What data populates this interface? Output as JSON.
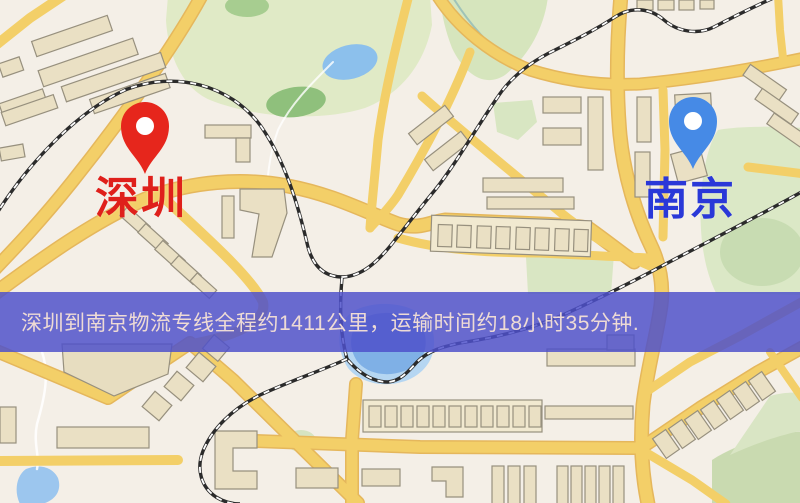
{
  "app": {
    "description": "logistics route map screenshot"
  },
  "banner": {
    "text": "深圳到南京物流专线全程约1411公里，运输时间约18小时35分钟.",
    "background_color": "#4d50cb",
    "text_color": "#eedbd5"
  },
  "markers": [
    {
      "id": "shenzhen",
      "label": "深圳",
      "label_color": "#df201b",
      "pin_color": "#e6261c",
      "pin_icon": "map-pin-red"
    },
    {
      "id": "nanjing",
      "label": "南京",
      "label_color": "#2a38d8",
      "pin_color": "#468ae6",
      "pin_icon": "map-pin-blue"
    }
  ],
  "route": {
    "from": "深圳",
    "to": "南京",
    "distance_km": "1411",
    "duration_hours": "18",
    "duration_minutes": "35"
  },
  "map_colors": {
    "background": "#f4efe7",
    "road_yellow": "#f3cf68",
    "road_casing": "#e5b75c",
    "building_fill": "#eae0c4",
    "park_green": "#dfe9c5",
    "water_blue": "#7fb0e6",
    "railway": "#2b2b2b"
  }
}
